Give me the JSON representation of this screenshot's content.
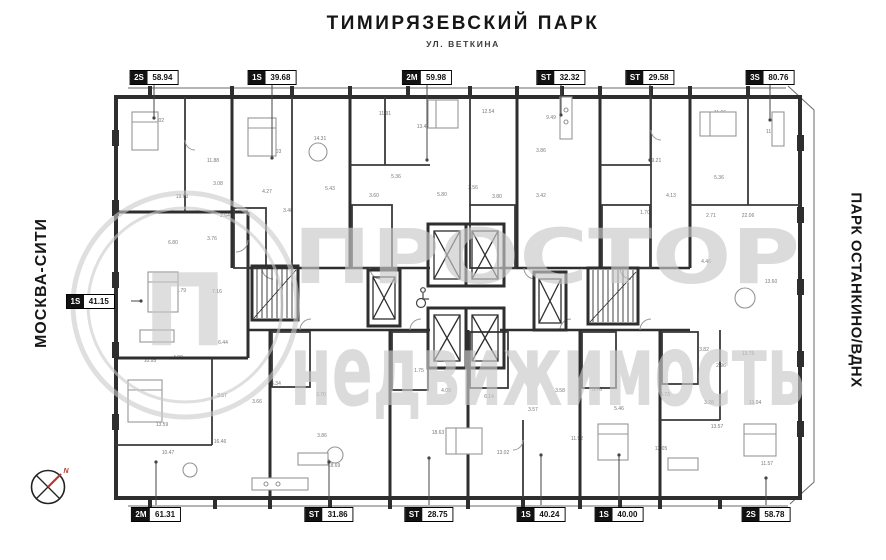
{
  "header": {
    "title": "ТИМИРЯЗЕВСКИЙ ПАРК",
    "subtitle": "УЛ. ВЕТКИНА"
  },
  "side_labels": {
    "left": "МОСКВА-СИТИ",
    "right": "ПАРК ОСТАНКИНО/ВДНХ"
  },
  "watermark": {
    "line1": "ПРОСТОР",
    "line2": "недвижимость",
    "logo_letter": "П"
  },
  "compass": {
    "north_label": "N"
  },
  "colors": {
    "wall": "#2e2e2e",
    "watermark": "#c9c9c9",
    "tag_bg": "#121212",
    "north_red": "#b03a2e"
  },
  "unit_tags": [
    {
      "side": "top",
      "code": "2S",
      "area": "58.94",
      "x": 154,
      "leader": [
        154,
        85,
        154,
        118
      ]
    },
    {
      "side": "top",
      "code": "1S",
      "area": "39.68",
      "x": 272,
      "leader": [
        272,
        85,
        272,
        158
      ]
    },
    {
      "side": "top",
      "code": "2M",
      "area": "59.98",
      "x": 427,
      "leader": [
        427,
        85,
        427,
        160
      ]
    },
    {
      "side": "top",
      "code": "ST",
      "area": "32.32",
      "x": 561,
      "leader": [
        561,
        85,
        561,
        115
      ]
    },
    {
      "side": "top",
      "code": "ST",
      "area": "29.58",
      "x": 650,
      "leader": [
        650,
        85,
        650,
        160
      ]
    },
    {
      "side": "top",
      "code": "3S",
      "area": "80.76",
      "x": 770,
      "leader": [
        770,
        85,
        770,
        120
      ]
    },
    {
      "side": "bottom",
      "code": "2M",
      "area": "61.31",
      "x": 156,
      "leader": [
        156,
        505,
        156,
        462
      ]
    },
    {
      "side": "bottom",
      "code": "ST",
      "area": "31.86",
      "x": 329,
      "leader": [
        329,
        505,
        329,
        462
      ]
    },
    {
      "side": "bottom",
      "code": "ST",
      "area": "28.75",
      "x": 429,
      "leader": [
        429,
        505,
        429,
        458
      ]
    },
    {
      "side": "bottom",
      "code": "1S",
      "area": "40.24",
      "x": 541,
      "leader": [
        541,
        505,
        541,
        455
      ]
    },
    {
      "side": "bottom",
      "code": "1S",
      "area": "40.00",
      "x": 619,
      "leader": [
        619,
        505,
        619,
        455
      ]
    },
    {
      "side": "bottom",
      "code": "2S",
      "area": "58.78",
      "x": 766,
      "leader": [
        766,
        505,
        766,
        478
      ]
    },
    {
      "side": "left",
      "code": "1S",
      "area": "41.15",
      "x": 66,
      "leader": [
        131,
        301,
        141,
        301
      ]
    }
  ],
  "room_labels": [
    {
      "x": 158,
      "y": 122,
      "v": "11.02"
    },
    {
      "x": 213,
      "y": 162,
      "v": "11.88"
    },
    {
      "x": 182,
      "y": 198,
      "v": "19.63"
    },
    {
      "x": 173,
      "y": 244,
      "v": "6.80"
    },
    {
      "x": 212,
      "y": 240,
      "v": "3.76"
    },
    {
      "x": 225,
      "y": 217,
      "v": "2.64"
    },
    {
      "x": 218,
      "y": 185,
      "v": "3.08"
    },
    {
      "x": 275,
      "y": 153,
      "v": "12.03"
    },
    {
      "x": 320,
      "y": 140,
      "v": "14.31"
    },
    {
      "x": 267,
      "y": 193,
      "v": "4.27"
    },
    {
      "x": 288,
      "y": 212,
      "v": "3.46"
    },
    {
      "x": 330,
      "y": 190,
      "v": "5.43"
    },
    {
      "x": 385,
      "y": 115,
      "v": "11.91"
    },
    {
      "x": 423,
      "y": 128,
      "v": "13.41"
    },
    {
      "x": 396,
      "y": 178,
      "v": "5.36"
    },
    {
      "x": 374,
      "y": 197,
      "v": "3.60"
    },
    {
      "x": 442,
      "y": 196,
      "v": "5.80"
    },
    {
      "x": 488,
      "y": 113,
      "v": "12.54"
    },
    {
      "x": 473,
      "y": 189,
      "v": "3.56"
    },
    {
      "x": 497,
      "y": 198,
      "v": "3.80"
    },
    {
      "x": 551,
      "y": 119,
      "v": "9.49"
    },
    {
      "x": 541,
      "y": 152,
      "v": "3.86"
    },
    {
      "x": 541,
      "y": 197,
      "v": "3.42"
    },
    {
      "x": 655,
      "y": 162,
      "v": "19.21"
    },
    {
      "x": 671,
      "y": 197,
      "v": "4.13"
    },
    {
      "x": 645,
      "y": 214,
      "v": "1.70"
    },
    {
      "x": 720,
      "y": 114,
      "v": "11.66"
    },
    {
      "x": 772,
      "y": 133,
      "v": "11.09"
    },
    {
      "x": 719,
      "y": 179,
      "v": "5.36"
    },
    {
      "x": 711,
      "y": 217,
      "v": "2.71"
    },
    {
      "x": 748,
      "y": 217,
      "v": "22.06"
    },
    {
      "x": 180,
      "y": 292,
      "v": "11.79"
    },
    {
      "x": 217,
      "y": 293,
      "v": "7.16"
    },
    {
      "x": 223,
      "y": 344,
      "v": "6.44"
    },
    {
      "x": 706,
      "y": 263,
      "v": "4.46"
    },
    {
      "x": 771,
      "y": 283,
      "v": "13.60"
    },
    {
      "x": 419,
      "y": 372,
      "v": "1.75"
    },
    {
      "x": 150,
      "y": 362,
      "v": "10.95"
    },
    {
      "x": 178,
      "y": 359,
      "v": "4.99"
    },
    {
      "x": 162,
      "y": 426,
      "v": "13.59"
    },
    {
      "x": 168,
      "y": 454,
      "v": "10.47"
    },
    {
      "x": 220,
      "y": 443,
      "v": "16.46"
    },
    {
      "x": 222,
      "y": 397,
      "v": "3.57"
    },
    {
      "x": 257,
      "y": 403,
      "v": "3.66"
    },
    {
      "x": 276,
      "y": 385,
      "v": "5.34"
    },
    {
      "x": 321,
      "y": 396,
      "v": "3.70"
    },
    {
      "x": 322,
      "y": 437,
      "v": "3.86"
    },
    {
      "x": 334,
      "y": 467,
      "v": "18.69"
    },
    {
      "x": 446,
      "y": 392,
      "v": "4.09"
    },
    {
      "x": 489,
      "y": 398,
      "v": "6.14"
    },
    {
      "x": 438,
      "y": 434,
      "v": "18.63"
    },
    {
      "x": 503,
      "y": 454,
      "v": "13.02"
    },
    {
      "x": 533,
      "y": 411,
      "v": "3.57"
    },
    {
      "x": 560,
      "y": 392,
      "v": "3.58"
    },
    {
      "x": 577,
      "y": 440,
      "v": "11.92"
    },
    {
      "x": 608,
      "y": 439,
      "v": "12.00"
    },
    {
      "x": 597,
      "y": 391,
      "v": "3.76"
    },
    {
      "x": 619,
      "y": 410,
      "v": "5.46"
    },
    {
      "x": 665,
      "y": 396,
      "v": "5.73"
    },
    {
      "x": 661,
      "y": 450,
      "v": "13.05"
    },
    {
      "x": 704,
      "y": 351,
      "v": "3.82"
    },
    {
      "x": 721,
      "y": 367,
      "v": "2.96"
    },
    {
      "x": 709,
      "y": 404,
      "v": "3.28"
    },
    {
      "x": 755,
      "y": 404,
      "v": "13.04"
    },
    {
      "x": 717,
      "y": 428,
      "v": "13.57"
    },
    {
      "x": 748,
      "y": 355,
      "v": "13.75"
    },
    {
      "x": 767,
      "y": 465,
      "v": "11.57"
    }
  ]
}
